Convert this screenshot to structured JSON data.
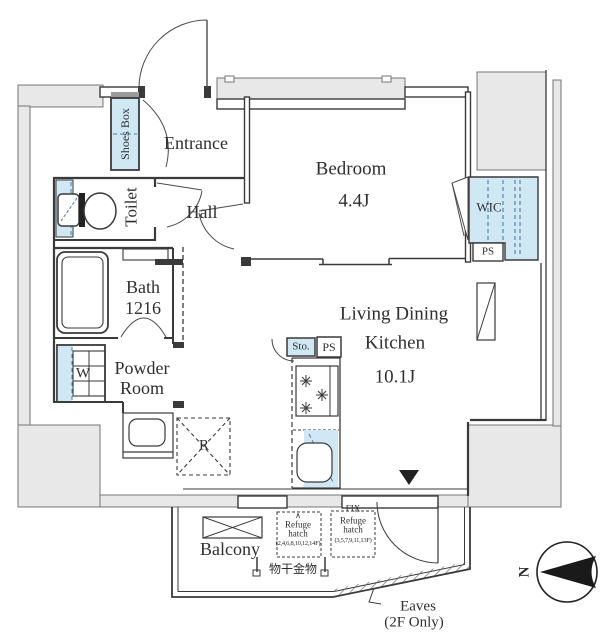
{
  "plan": {
    "colors": {
      "wall": "#3a3a3a",
      "exterior_gray": "#e8e8e8",
      "fixture_blue": "#cfe8f4",
      "blue_line": "#4a7ba6",
      "text": "#2f2f2f"
    },
    "rooms": {
      "entrance": "Entrance",
      "hall": "Hall",
      "toilet": "Toilet",
      "shoes_box": "Shoes Box",
      "bath": "Bath",
      "bath_size": "1216",
      "powder_1": "Powder",
      "powder_2": "Room",
      "bedroom": "Bedroom",
      "bedroom_size": "4.4J",
      "wic": "WIC",
      "ldk_1": "Living Dining",
      "ldk_2": "Kitchen",
      "ldk_size": "10.1J",
      "balcony": "Balcony"
    },
    "fixtures": {
      "washer": "W",
      "fridge": "R",
      "storage": "Sto.",
      "pipe_space_kitchen": "PS",
      "pipe_space_wic": "PS"
    },
    "balcony_items": {
      "hatch_even": {
        "marker": "∧",
        "line1": "Refuge",
        "line2": "hatch",
        "floors": "(2,4,6,8,10,12,14F)"
      },
      "hatch_odd": {
        "fix": "FIX",
        "line1": "Refuge",
        "line2": "hatch",
        "floors": "(3,5,7,9,11,13F)"
      },
      "laundry_hardware": "物干金物"
    },
    "annotations": {
      "eaves_1": "Eaves",
      "eaves_2": "(2F Only)",
      "north": "N"
    }
  }
}
